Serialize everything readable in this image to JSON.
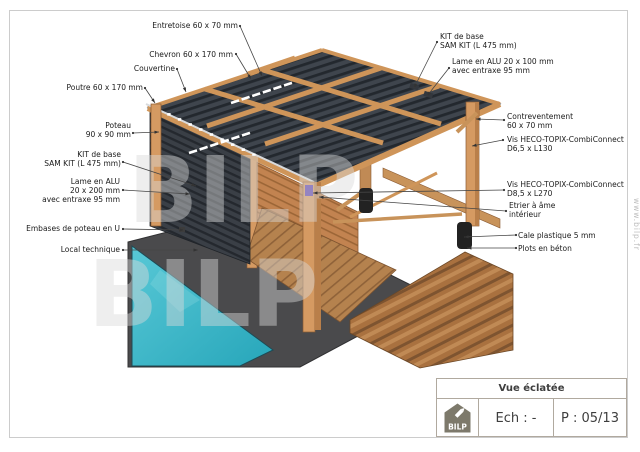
{
  "drawing": {
    "type": "exploded-view technical drawing",
    "subject": "pergola / pool-house wood structure with ALU slats"
  },
  "annotations": {
    "left": [
      {
        "id": "entretoise",
        "lines": [
          "Entretoise 60 x 70 mm"
        ],
        "x": 238,
        "y": 28,
        "leader": [
          240,
          26,
          262,
          76
        ]
      },
      {
        "id": "chevron",
        "lines": [
          "Chevron 60 x 170 mm"
        ],
        "x": 233,
        "y": 57,
        "leader": [
          236,
          54,
          251,
          79
        ]
      },
      {
        "id": "couvertine",
        "lines": [
          "Couvertine"
        ],
        "x": 175,
        "y": 71,
        "leader": [
          177,
          69,
          186,
          92
        ]
      },
      {
        "id": "poutre",
        "lines": [
          "Poutre 60 x 170 mm"
        ],
        "x": 143,
        "y": 90,
        "leader": [
          145,
          88,
          155,
          103
        ]
      },
      {
        "id": "poteau",
        "lines": [
          "Poteau",
          "90 x 90 mm"
        ],
        "x": 131,
        "y": 128,
        "leader": [
          133,
          133,
          159,
          132
        ]
      },
      {
        "id": "kit-base-gauche",
        "lines": [
          "KIT de base",
          "SAM KIT (L 475 mm)"
        ],
        "x": 121,
        "y": 157,
        "leader": [
          123,
          162,
          196,
          186
        ]
      },
      {
        "id": "lame-alu-200",
        "lines": [
          "Lame en ALU",
          "20 x 200 mm",
          "avec entraxe 95 mm"
        ],
        "x": 120,
        "y": 184,
        "leader": [
          123,
          190,
          190,
          194
        ]
      },
      {
        "id": "embases",
        "lines": [
          "Embases de poteau en U"
        ],
        "x": 120,
        "y": 231,
        "leader": [
          123,
          229,
          184,
          230
        ]
      },
      {
        "id": "local-technique",
        "lines": [
          "Local technique"
        ],
        "x": 120,
        "y": 252,
        "leader": [
          123,
          250,
          198,
          250
        ]
      }
    ],
    "right": [
      {
        "id": "kit-base-droite",
        "lines": [
          "KIT de base",
          "SAM KIT (L 475 mm)"
        ],
        "x": 440,
        "y": 39,
        "leader": [
          437,
          42,
          414,
          88
        ]
      },
      {
        "id": "lame-alu-100",
        "lines": [
          "Lame en ALU 20 x 100 mm",
          "avec entraxe 95 mm"
        ],
        "x": 452,
        "y": 64,
        "leader": [
          449,
          68,
          427,
          96
        ]
      },
      {
        "id": "contreventement",
        "lines": [
          "Contreventement",
          "60 x 70 mm"
        ],
        "x": 507,
        "y": 119,
        "leader": [
          504,
          120,
          476,
          119
        ]
      },
      {
        "id": "vis-heco-d65",
        "lines": [
          "Vis HECO-TOPIX-CombiConnect",
          "D6,5 x L130"
        ],
        "x": 507,
        "y": 142,
        "leader": [
          503,
          140,
          472,
          146
        ]
      },
      {
        "id": "vis-heco-d85",
        "lines": [
          "Vis HECO-TOPIX-CombiConnect",
          "D8,5 x L270"
        ],
        "x": 507,
        "y": 187,
        "leader": [
          504,
          190,
          313,
          193
        ]
      },
      {
        "id": "etrier",
        "lines": [
          "Etrier à âme",
          "intérieur"
        ],
        "x": 509,
        "y": 208,
        "leader": [
          506,
          211,
          319,
          197
        ]
      },
      {
        "id": "cale-plastique",
        "lines": [
          "Cale plastique 5 mm"
        ],
        "x": 518,
        "y": 238,
        "leader": [
          516,
          235,
          464,
          237
        ]
      },
      {
        "id": "plots-beton",
        "lines": [
          "Plots en béton"
        ],
        "x": 518,
        "y": 251,
        "leader": [
          516,
          248,
          467,
          248
        ]
      }
    ]
  },
  "title_block": {
    "title": "Vue éclatée",
    "scale_label": "Ech : -",
    "page_label": "P : 05/13",
    "logo_text": "BILP",
    "logo_icon": "house-pencil-icon"
  },
  "watermark": {
    "brand": "BILP",
    "url": "www.bilp.fr"
  },
  "colors": {
    "wood": "#d59a62",
    "wood_dark": "#b97f4a",
    "slat_dark": "#3a3f46",
    "pool": "#3ab7c8",
    "concrete": "#4a4a4c",
    "deck": "#b5824e",
    "label_text": "#1b1b1b",
    "titleblock_border": "#b0a99f",
    "logo_gray": "#7d796b"
  }
}
